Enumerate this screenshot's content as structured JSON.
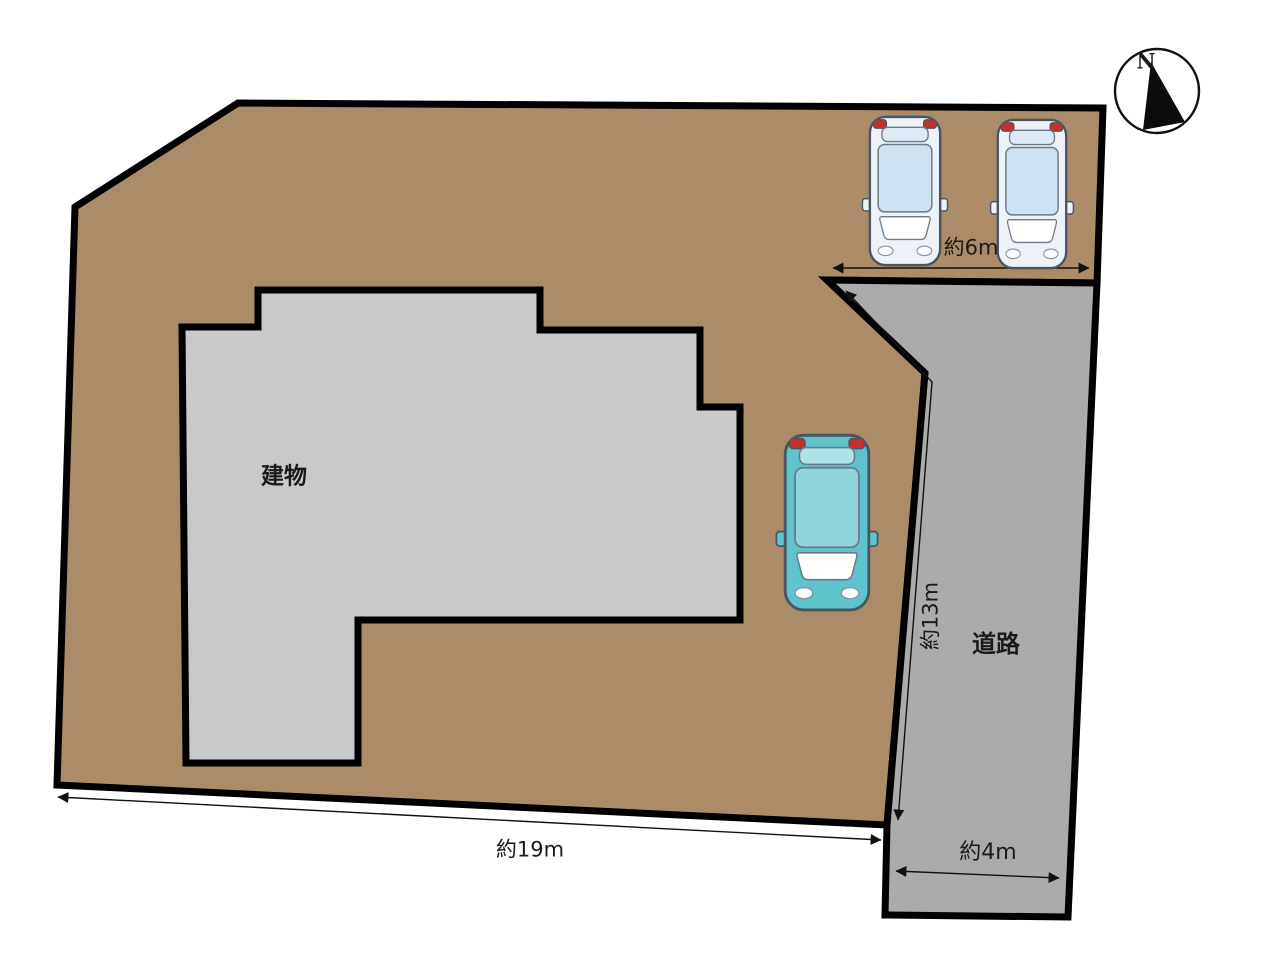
{
  "diagram": {
    "type": "property-site-plan",
    "labels": {
      "building": "建物",
      "road": "道路",
      "compass_north": "N"
    },
    "dimensions": {
      "frontage_top": "約6m",
      "road_length": "約13m",
      "site_width": "約19m",
      "road_width": "約4m"
    },
    "colors": {
      "site": "#AC8C68",
      "building": "#C9C9CB",
      "road": "#ABABAB",
      "car_compact": "#ECF2F8",
      "car_teal": "#5FC3CD"
    },
    "icons": {
      "compass": "compass-north-icon",
      "cars": [
        "car-icon",
        "car-icon",
        "car-icon"
      ]
    }
  }
}
